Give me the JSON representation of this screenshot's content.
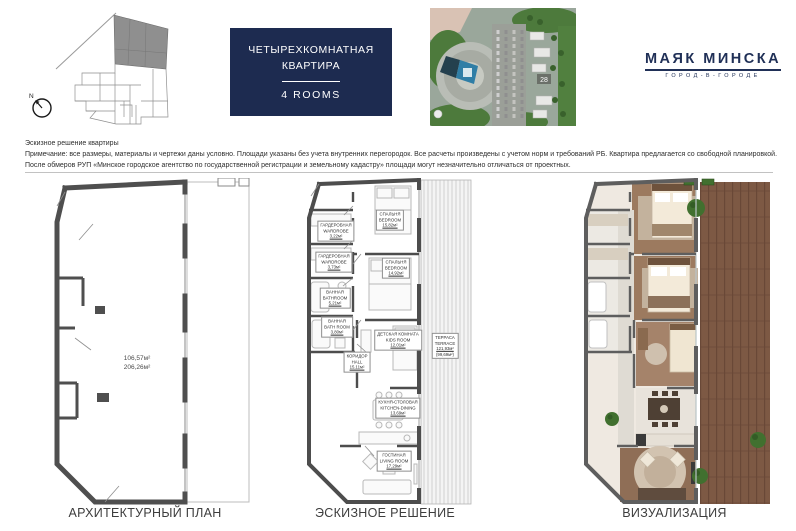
{
  "title_box": {
    "line1": "ЧЕТЫРЕХКОМНАТНАЯ",
    "line2": "КВАРТИРА",
    "rooms": "4 ROOMS"
  },
  "logo": {
    "name": "МАЯК МИНСКА",
    "tagline": "ГОРОД-В-ГОРОДЕ"
  },
  "site_plan": {
    "compass_label": "N"
  },
  "aerial": {
    "building_number": "28"
  },
  "disclaimer": {
    "line1": "Эскизное решение квартиры",
    "line2": "Примечание: все размеры, материалы и чертежи даны условно. Площади указаны без учета внутренних перегородок. Все расчеты произведены с учетом норм и требований РБ. Квартира предлагается со свободной планировкой.",
    "line3": "После обмеров РУП «Минское городское агентство по государственной регистрации и земельному кадастру» площади могут незначительно отличаться от проектных."
  },
  "plans": {
    "architectural": {
      "caption": "АРХИТЕКТУРНЫЙ ПЛАН",
      "area_main": "106,57м²",
      "area_total": "206,26м²"
    },
    "sketch": {
      "caption": "ЭСКИЗНОЕ РЕШЕНИЕ",
      "rooms": [
        {
          "ru": "СПАЛЬНЯ",
          "en": "BEDROOM",
          "area": "15,82м²"
        },
        {
          "ru": "ГАРДЕРОБНАЯ",
          "en": "WARDROBE",
          "area": "3,22м²"
        },
        {
          "ru": "ГАРДЕРОБНАЯ",
          "en": "WARDROBE",
          "area": "3,73м²"
        },
        {
          "ru": "СПАЛЬНЯ",
          "en": "BEDROOM",
          "area": "14,92м²"
        },
        {
          "ru": "ВАННАЯ",
          "en": "BATHROOM",
          "area": "5,21м²"
        },
        {
          "ru": "ВАННАЯ",
          "en": "BATH ROOM",
          "area": "3,80м²"
        },
        {
          "ru": "ДЕТСКАЯ КОМНАТА",
          "en": "KIDS ROOM",
          "area": "12,01м²"
        },
        {
          "ru": "КОРИДОР",
          "en": "HALL",
          "area": "15,11м²"
        },
        {
          "ru": "ТЕРРАСА",
          "en": "TERRACE",
          "area": "121,93м²",
          "area2": "(99,69м²)"
        },
        {
          "ru": "КУХНЯ-СТОЛОВАЯ",
          "en": "KITCHEN-DINING",
          "area": "13,69м²"
        },
        {
          "ru": "ГОСТИНАЯ",
          "en": "LIVING ROOM",
          "area": "17,29м²"
        }
      ]
    },
    "visualization": {
      "caption": "ВИЗУАЛИЗАЦИЯ"
    }
  }
}
